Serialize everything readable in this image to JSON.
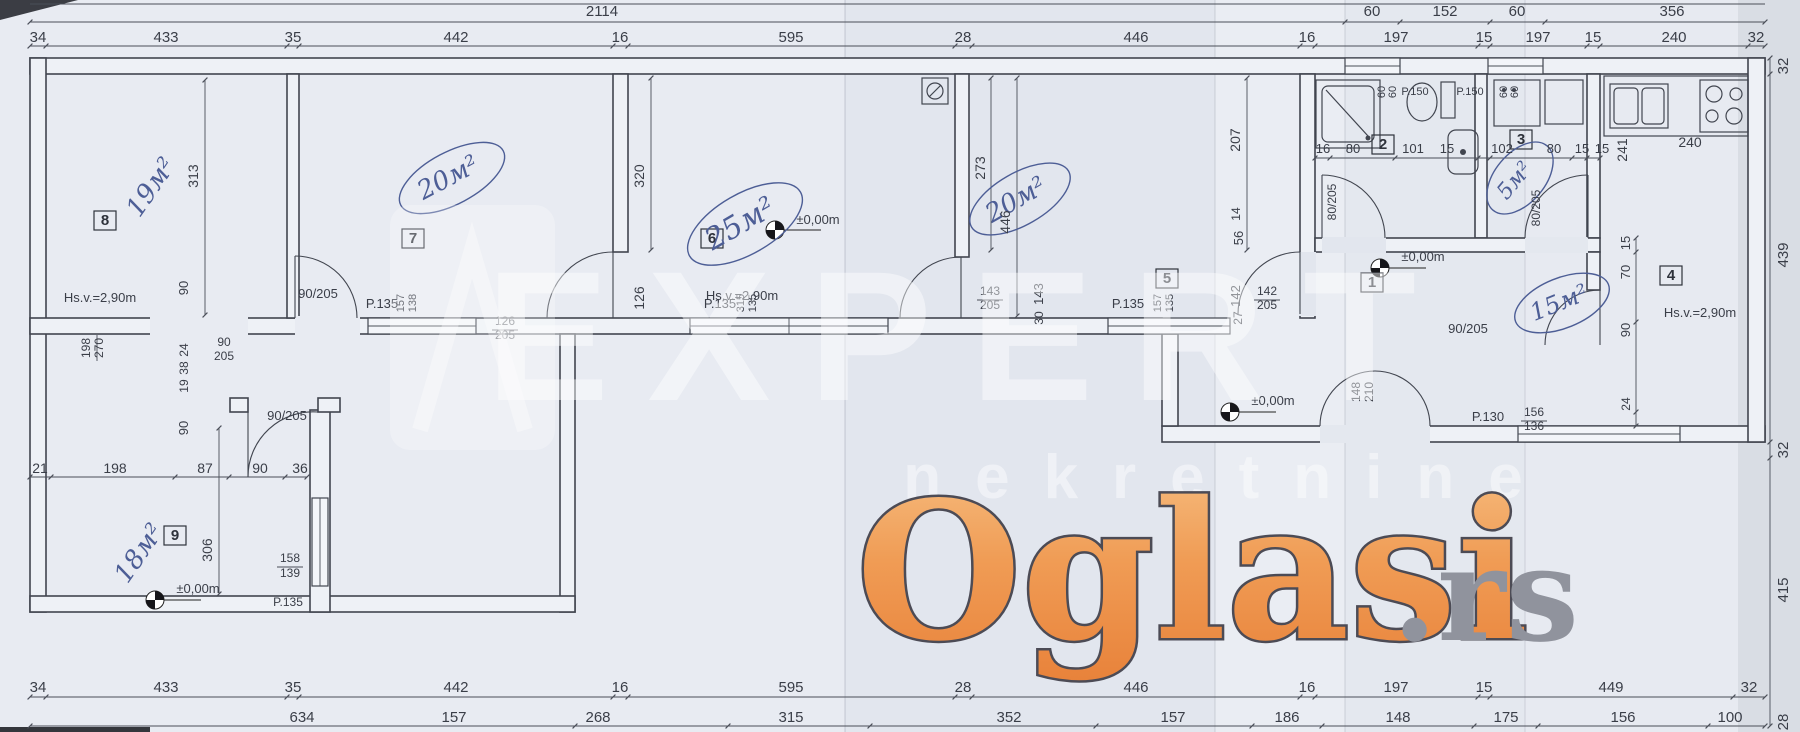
{
  "watermark": {
    "brand": "Oglasi",
    "tld": ".rs",
    "brand_color": "#ee9148",
    "brand_outline": "#4c4b55",
    "tld_color": "#90939d",
    "agency": "EXPERT",
    "agency_sub": "nekretnine"
  },
  "plan": {
    "overall_width": "2114",
    "level_mark": "±0,00m",
    "ceiling_note": "Hs.v.=2,90m",
    "rooms": [
      {
        "no": "1",
        "type": "hall"
      },
      {
        "no": "2",
        "type": "bathroom"
      },
      {
        "no": "3",
        "type": "bathroom",
        "area": "5м²"
      },
      {
        "no": "4",
        "type": "kitchen",
        "area": "15м²",
        "ceiling": "Hs.v.=2,90m"
      },
      {
        "no": "5",
        "area": "20м²"
      },
      {
        "no": "6",
        "area": "25м²",
        "ceiling": "Hs.v.=2,90m"
      },
      {
        "no": "7",
        "area": "20м²"
      },
      {
        "no": "8",
        "area": "19м²",
        "ceiling": "Hs.v.=2,90m"
      },
      {
        "no": "9",
        "area": "18м²"
      }
    ],
    "window_codes": [
      "P.135",
      "P.150",
      "P.130"
    ],
    "door_codes": [
      "90/205",
      "80/205",
      "126/205",
      "142/205",
      "143/205",
      "148/210"
    ]
  },
  "labels": [
    {
      "t": "2114",
      "x": 602,
      "y": 16,
      "n": "dim-total-width"
    },
    {
      "t": "60",
      "x": 1372,
      "y": 16
    },
    {
      "t": "152",
      "x": 1445,
      "y": 16
    },
    {
      "t": "60",
      "x": 1517,
      "y": 16
    },
    {
      "t": "356",
      "x": 1672,
      "y": 16
    },
    {
      "t": "34",
      "x": 38,
      "y": 42
    },
    {
      "t": "433",
      "x": 166,
      "y": 42
    },
    {
      "t": "35",
      "x": 293,
      "y": 42
    },
    {
      "t": "442",
      "x": 456,
      "y": 42
    },
    {
      "t": "16",
      "x": 620,
      "y": 42
    },
    {
      "t": "595",
      "x": 791,
      "y": 42
    },
    {
      "t": "28",
      "x": 963,
      "y": 42
    },
    {
      "t": "446",
      "x": 1136,
      "y": 42
    },
    {
      "t": "16",
      "x": 1307,
      "y": 42
    },
    {
      "t": "197",
      "x": 1396,
      "y": 42
    },
    {
      "t": "15",
      "x": 1484,
      "y": 42
    },
    {
      "t": "197",
      "x": 1538,
      "y": 42
    },
    {
      "t": "15",
      "x": 1593,
      "y": 42
    },
    {
      "t": "240",
      "x": 1674,
      "y": 42
    },
    {
      "t": "32",
      "x": 1756,
      "y": 42
    },
    {
      "t": "34",
      "x": 38,
      "y": 692
    },
    {
      "t": "433",
      "x": 166,
      "y": 692
    },
    {
      "t": "35",
      "x": 293,
      "y": 692
    },
    {
      "t": "442",
      "x": 456,
      "y": 692
    },
    {
      "t": "16",
      "x": 620,
      "y": 692
    },
    {
      "t": "595",
      "x": 791,
      "y": 692
    },
    {
      "t": "28",
      "x": 963,
      "y": 692
    },
    {
      "t": "446",
      "x": 1136,
      "y": 692
    },
    {
      "t": "16",
      "x": 1307,
      "y": 692
    },
    {
      "t": "197",
      "x": 1396,
      "y": 692
    },
    {
      "t": "15",
      "x": 1484,
      "y": 692
    },
    {
      "t": "449",
      "x": 1611,
      "y": 692
    },
    {
      "t": "32",
      "x": 1749,
      "y": 692
    },
    {
      "t": "634",
      "x": 302,
      "y": 722
    },
    {
      "t": "157",
      "x": 454,
      "y": 722
    },
    {
      "t": "268",
      "x": 598,
      "y": 722
    },
    {
      "t": "315",
      "x": 791,
      "y": 722
    },
    {
      "t": "352",
      "x": 1009,
      "y": 722
    },
    {
      "t": "157",
      "x": 1173,
      "y": 722
    },
    {
      "t": "186",
      "x": 1287,
      "y": 722
    },
    {
      "t": "148",
      "x": 1398,
      "y": 722
    },
    {
      "t": "175",
      "x": 1506,
      "y": 722
    },
    {
      "t": "156",
      "x": 1623,
      "y": 722
    },
    {
      "t": "100",
      "x": 1730,
      "y": 722
    },
    {
      "t": "32",
      "x": 1788,
      "y": 66,
      "r": -90
    },
    {
      "t": "439",
      "x": 1788,
      "y": 255,
      "r": -90
    },
    {
      "t": "32",
      "x": 1788,
      "y": 450,
      "r": -90
    },
    {
      "t": "415",
      "x": 1788,
      "y": 590,
      "r": -90
    },
    {
      "t": "28",
      "x": 1788,
      "y": 722,
      "r": -90
    },
    {
      "t": "8",
      "x": 105,
      "y": 225,
      "c": "roomno",
      "n": "room-label-8"
    },
    {
      "t": "7",
      "x": 413,
      "y": 243,
      "c": "roomno",
      "n": "room-label-7"
    },
    {
      "t": "6",
      "x": 712,
      "y": 243,
      "c": "roomno",
      "n": "room-label-6"
    },
    {
      "t": "5",
      "x": 1167,
      "y": 283,
      "c": "roomno",
      "n": "room-label-5"
    },
    {
      "t": "1",
      "x": 1372,
      "y": 287,
      "c": "roomno",
      "n": "room-label-1"
    },
    {
      "t": "2",
      "x": 1383,
      "y": 149,
      "c": "roomno",
      "n": "room-label-2"
    },
    {
      "t": "3",
      "x": 1521,
      "y": 144,
      "c": "roomno",
      "n": "room-label-3"
    },
    {
      "t": "4",
      "x": 1671,
      "y": 280,
      "c": "roomno",
      "n": "room-label-4"
    },
    {
      "t": "9",
      "x": 175,
      "y": 540,
      "c": "roomno",
      "n": "room-label-9"
    },
    {
      "t": "19м²",
      "x": 158,
      "y": 192,
      "r": -55,
      "s": 26,
      "c": "hand",
      "n": "area-note-room8"
    },
    {
      "t": "20м²",
      "x": 452,
      "y": 185,
      "r": -28,
      "s": 26,
      "c": "hand",
      "n": "area-note-room7"
    },
    {
      "t": "25м²",
      "x": 745,
      "y": 232,
      "r": -30,
      "s": 30,
      "c": "hand",
      "n": "area-note-room6"
    },
    {
      "t": "20м²",
      "x": 1020,
      "y": 207,
      "r": -30,
      "s": 26,
      "c": "hand",
      "n": "area-note-room5"
    },
    {
      "t": "5м²",
      "x": 1520,
      "y": 185,
      "r": -50,
      "s": 22,
      "c": "hand",
      "n": "area-note-room3"
    },
    {
      "t": "15м²",
      "x": 1562,
      "y": 310,
      "r": -22,
      "s": 24,
      "c": "hand",
      "n": "area-note-room4"
    },
    {
      "t": "18м²",
      "x": 146,
      "y": 558,
      "r": -55,
      "s": 26,
      "c": "hand",
      "n": "area-note-room9"
    },
    {
      "t": "Hs.v.=2,90m",
      "x": 100,
      "y": 302,
      "s": 13,
      "n": "ceiling-note"
    },
    {
      "t": "Hs.v.=2,90m",
      "x": 742,
      "y": 300,
      "s": 13,
      "n": "ceiling-note"
    },
    {
      "t": "Hs.v.=2,90m",
      "x": 1700,
      "y": 317,
      "s": 13,
      "n": "ceiling-note"
    },
    {
      "t": "±0,00m",
      "x": 818,
      "y": 224,
      "s": 13,
      "n": "level-mark"
    },
    {
      "t": "±0,00m",
      "x": 1273,
      "y": 405,
      "s": 13,
      "n": "level-mark"
    },
    {
      "t": "±0,00m",
      "x": 1423,
      "y": 261,
      "s": 13,
      "n": "level-mark"
    },
    {
      "t": "±0,00m",
      "x": 198,
      "y": 593,
      "s": 13,
      "n": "level-mark"
    },
    {
      "t": "313",
      "x": 198,
      "y": 176,
      "r": -90,
      "s": 14
    },
    {
      "t": "320",
      "x": 644,
      "y": 176,
      "r": -90,
      "s": 14
    },
    {
      "t": "126",
      "x": 644,
      "y": 298,
      "r": -90,
      "s": 14
    },
    {
      "t": "273",
      "x": 985,
      "y": 168,
      "r": -90,
      "s": 14
    },
    {
      "t": "446",
      "x": 1010,
      "y": 222,
      "r": -90,
      "s": 14
    },
    {
      "t": "143",
      "x": 1043,
      "y": 294,
      "r": -90,
      "s": 13
    },
    {
      "t": "30",
      "x": 1043,
      "y": 318,
      "r": -90,
      "s": 12
    },
    {
      "t": "142",
      "x": 1240,
      "y": 296,
      "r": -90,
      "s": 13
    },
    {
      "t": "27",
      "x": 1242,
      "y": 318,
      "r": -90,
      "s": 12
    },
    {
      "t": "56",
      "x": 1243,
      "y": 238,
      "r": -90,
      "s": 13
    },
    {
      "t": "14",
      "x": 1240,
      "y": 214,
      "r": -90,
      "s": 12
    },
    {
      "t": "207",
      "x": 1240,
      "y": 140,
      "r": -90,
      "s": 14
    },
    {
      "t": "306",
      "x": 212,
      "y": 550,
      "r": -90,
      "s": 14
    },
    {
      "t": "90",
      "x": 188,
      "y": 288,
      "r": -90,
      "s": 13
    },
    {
      "t": "24",
      "x": 188,
      "y": 350,
      "r": -90,
      "s": 12
    },
    {
      "t": "38",
      "x": 188,
      "y": 368,
      "r": -90,
      "s": 12
    },
    {
      "t": "19",
      "x": 188,
      "y": 386,
      "r": -90,
      "s": 12
    },
    {
      "t": "90",
      "x": 188,
      "y": 428,
      "r": -90,
      "s": 13
    },
    {
      "t": "198",
      "x": 90,
      "y": 348,
      "r": -90,
      "s": 12
    },
    {
      "t": "270",
      "x": 103,
      "y": 348,
      "r": -90,
      "s": 12
    },
    {
      "t": "90",
      "x": 224,
      "y": 346,
      "s": 12
    },
    {
      "t": "205",
      "x": 224,
      "y": 360,
      "s": 12
    },
    {
      "t": "241",
      "x": 1627,
      "y": 150,
      "r": -90,
      "s": 14
    },
    {
      "t": "15",
      "x": 1630,
      "y": 243,
      "r": -90,
      "s": 13
    },
    {
      "t": "70",
      "x": 1630,
      "y": 272,
      "r": -90,
      "s": 13
    },
    {
      "t": "90",
      "x": 1630,
      "y": 330,
      "r": -90,
      "s": 13
    },
    {
      "t": "24",
      "x": 1630,
      "y": 404,
      "r": -90,
      "s": 12
    },
    {
      "t": "157",
      "x": 404,
      "y": 303,
      "r": -90,
      "s": 11
    },
    {
      "t": "138",
      "x": 416,
      "y": 303,
      "r": -90,
      "s": 11
    },
    {
      "t": "315",
      "x": 744,
      "y": 303,
      "r": -90,
      "s": 11
    },
    {
      "t": "135",
      "x": 756,
      "y": 303,
      "r": -90,
      "s": 11
    },
    {
      "t": "157",
      "x": 1161,
      "y": 303,
      "r": -90,
      "s": 11
    },
    {
      "t": "135",
      "x": 1173,
      "y": 303,
      "r": -90,
      "s": 11
    },
    {
      "t": "80/205",
      "x": 1336,
      "y": 202,
      "r": -90,
      "s": 12,
      "n": "door-size"
    },
    {
      "t": "80/205",
      "x": 1540,
      "y": 208,
      "r": -90,
      "s": 12,
      "n": "door-size"
    },
    {
      "t": "148",
      "x": 1360,
      "y": 392,
      "r": -90,
      "s": 12
    },
    {
      "t": "210",
      "x": 1373,
      "y": 392,
      "r": -90,
      "s": 12
    },
    {
      "t": "60",
      "x": 1385,
      "y": 92,
      "r": -90,
      "s": 11
    },
    {
      "t": "60",
      "x": 1396,
      "y": 92,
      "r": -90,
      "s": 11
    },
    {
      "t": "60",
      "x": 1507,
      "y": 92,
      "r": -90,
      "s": 11
    },
    {
      "t": "60",
      "x": 1518,
      "y": 92,
      "r": -90,
      "s": 11
    },
    {
      "t": "143",
      "x": 990,
      "y": 295,
      "s": 12
    },
    {
      "t": "205",
      "x": 990,
      "y": 309,
      "s": 12
    },
    {
      "t": "142",
      "x": 1267,
      "y": 295,
      "s": 12
    },
    {
      "t": "205",
      "x": 1267,
      "y": 309,
      "s": 12
    },
    {
      "t": "126",
      "x": 505,
      "y": 325,
      "s": 12
    },
    {
      "t": "205",
      "x": 505,
      "y": 339,
      "s": 12
    },
    {
      "t": "158",
      "x": 290,
      "y": 562,
      "s": 12
    },
    {
      "t": "139",
      "x": 290,
      "y": 577,
      "s": 12
    },
    {
      "t": "156",
      "x": 1534,
      "y": 416,
      "s": 12
    },
    {
      "t": "136",
      "x": 1534,
      "y": 430,
      "s": 12
    },
    {
      "t": "P.135",
      "x": 382,
      "y": 308,
      "s": 13,
      "n": "window-code"
    },
    {
      "t": "P.135",
      "x": 720,
      "y": 308,
      "s": 13,
      "n": "window-code"
    },
    {
      "t": "P.135",
      "x": 1128,
      "y": 308,
      "s": 13,
      "n": "window-code"
    },
    {
      "t": "P.135",
      "x": 288,
      "y": 606,
      "s": 12,
      "n": "window-code"
    },
    {
      "t": "P.150",
      "x": 1415,
      "y": 95,
      "s": 11,
      "n": "window-code"
    },
    {
      "t": "P.150",
      "x": 1470,
      "y": 95,
      "s": 11,
      "n": "window-code"
    },
    {
      "t": "P.130",
      "x": 1488,
      "y": 421,
      "s": 13,
      "n": "window-code"
    },
    {
      "t": "90/205",
      "x": 318,
      "y": 298,
      "s": 13,
      "n": "door-size"
    },
    {
      "t": "90/205",
      "x": 287,
      "y": 420,
      "s": 13,
      "n": "door-size"
    },
    {
      "t": "90/205",
      "x": 1468,
      "y": 333,
      "s": 13,
      "n": "door-size"
    },
    {
      "t": "16",
      "x": 1323,
      "y": 153,
      "s": 13
    },
    {
      "t": "80",
      "x": 1353,
      "y": 153,
      "s": 13
    },
    {
      "t": "101",
      "x": 1413,
      "y": 153,
      "s": 13
    },
    {
      "t": "15",
      "x": 1447,
      "y": 153,
      "s": 13
    },
    {
      "t": "102",
      "x": 1502,
      "y": 153,
      "s": 13
    },
    {
      "t": "80",
      "x": 1554,
      "y": 153,
      "s": 13
    },
    {
      "t": "15",
      "x": 1582,
      "y": 153,
      "s": 13
    },
    {
      "t": "15",
      "x": 1602,
      "y": 153,
      "s": 13
    },
    {
      "t": "240",
      "x": 1690,
      "y": 147,
      "s": 14
    },
    {
      "t": "21",
      "x": 40,
      "y": 473,
      "s": 14
    },
    {
      "t": "198",
      "x": 115,
      "y": 473,
      "s": 14
    },
    {
      "t": "87",
      "x": 205,
      "y": 473,
      "s": 14
    },
    {
      "t": "90",
      "x": 260,
      "y": 473,
      "s": 14
    },
    {
      "t": "36",
      "x": 300,
      "y": 473,
      "s": 14
    }
  ]
}
